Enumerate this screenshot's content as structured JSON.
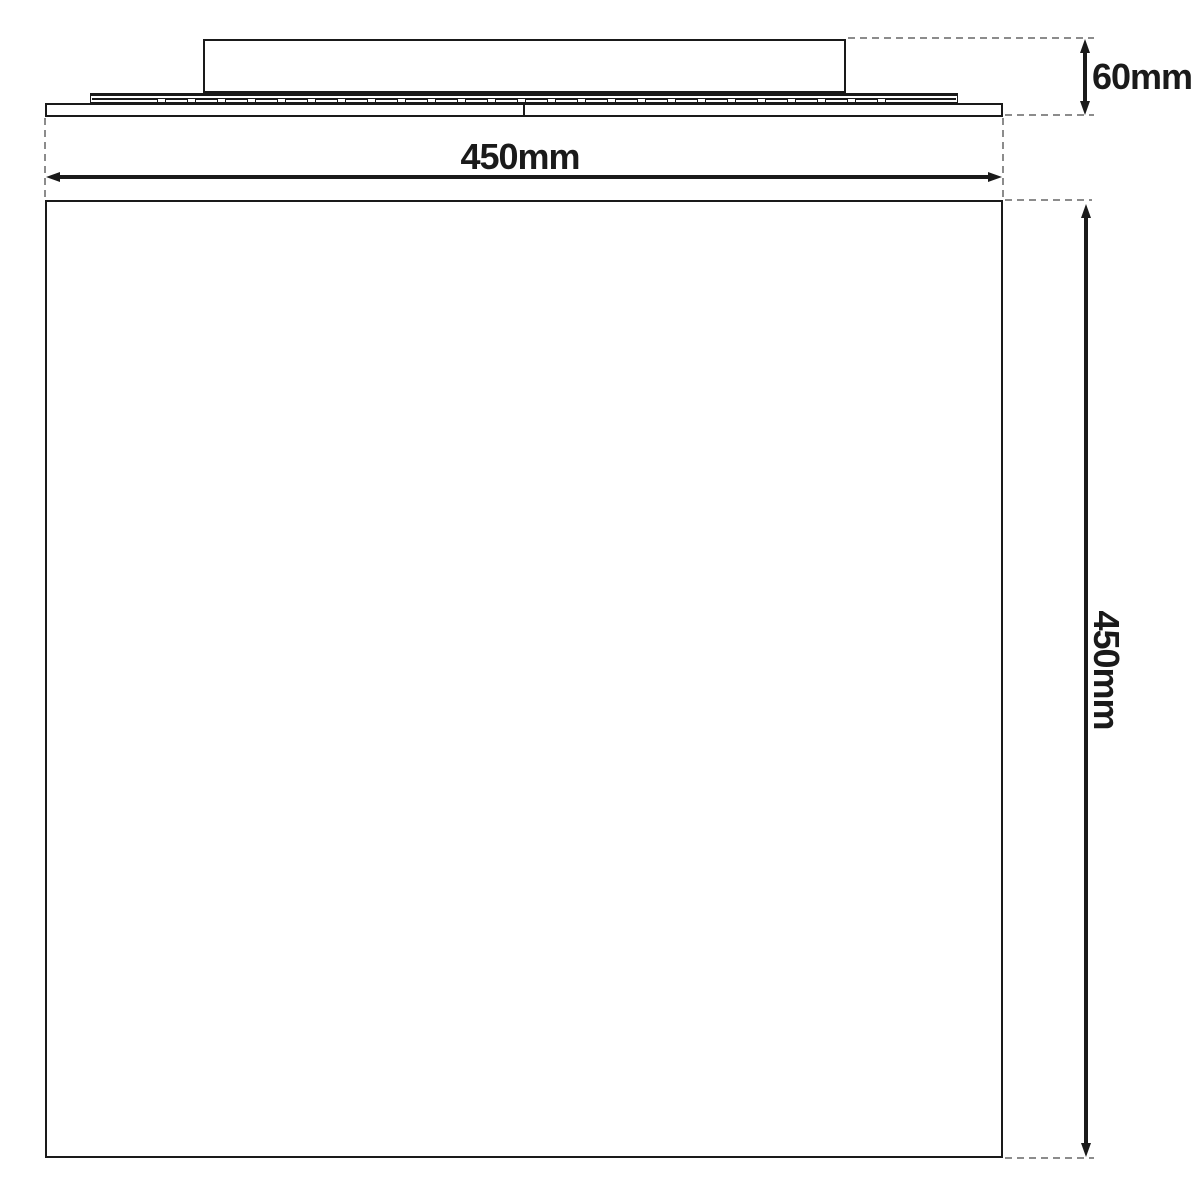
{
  "diagram": {
    "type": "product-dimension-drawing",
    "colors": {
      "line": "#1a1a1a",
      "dash": "#8c8c8c",
      "background": "#ffffff"
    },
    "dimensions": {
      "width_label": "450mm",
      "depth_label": "60mm",
      "height_label": "450mm"
    },
    "side_view": {
      "vent_slot_count": 25,
      "vent_slot_spacing": 30,
      "vent_slot_width": 9
    }
  }
}
